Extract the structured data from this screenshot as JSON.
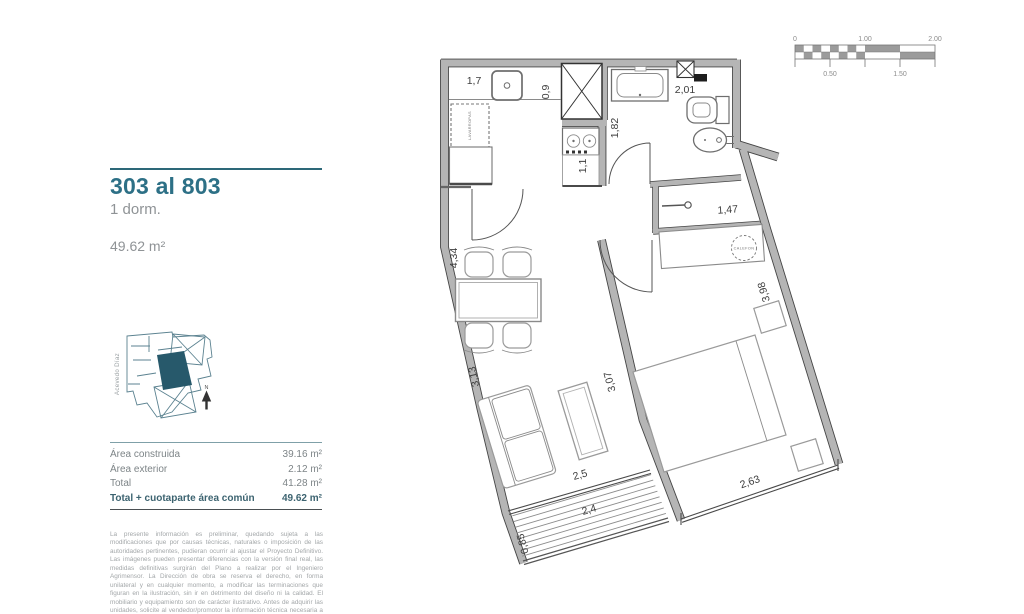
{
  "sidebar": {
    "title": "303 al 803",
    "subtitle": "1 dorm.",
    "area": "49.62 m²",
    "keyplan": {
      "street": "Acevedo Díaz",
      "north": "N"
    },
    "table": {
      "rows": [
        {
          "label": "Área construida",
          "value": "39.16 m²",
          "bold": false
        },
        {
          "label": "Área exterior",
          "value": "2.12 m²",
          "bold": false
        },
        {
          "label": "Total",
          "value": "41.28 m²",
          "bold": false
        },
        {
          "label": "Total + cuotaparte área común",
          "value": "49.62 m²",
          "bold": true
        }
      ]
    },
    "disclaimer": "La presente información es preliminar, quedando sujeta a las modificaciones que por causas técnicas, naturales o imposición de las autoridades pertinentes, pudieran ocurrir al ajustar el Proyecto Definitivo. Las imágenes pueden presentar diferencias con la versión final real, las medidas definitivas surgirán del Plano a realizar por el Ingeniero Agrimensor. La Dirección de obra se reserva el derecho, en forma unilateral y en cualquier momento, a modificar las terminaciones que figuran en la ilustración, sin ir en detrimento del diseño ni la calidad. El mobiliario y equipamiento son de carácter ilustrativo. Antes de adquirir las unidades, solicite al vendedor/promotor la información técnica necesaria a efectos de confirmar los datos obtenidos y poder tomar una decisión informada."
  },
  "scalebar": {
    "top": [
      "0",
      "1.00",
      "2.00"
    ],
    "bottom": [
      "0.50",
      "1.50"
    ]
  },
  "plan": {
    "dims": {
      "d17": "1,7",
      "d09": "0,9",
      "d201": "2,01",
      "d182": "1,82",
      "d11": "1,1",
      "d434": "4,34",
      "d147": "1,47",
      "d398": "3,98",
      "d313": "3,13",
      "d307": "3,07",
      "d25": "2,5",
      "d24": "2,4",
      "d085": "0,85",
      "d263": "2,63"
    },
    "labels": {
      "washer": "LAVARROPAS",
      "heater": "CALEFON"
    }
  },
  "colors": {
    "accent": "#2d7086",
    "wall": "#b5b5b5",
    "wallEdge": "#454545",
    "dim": "#3d3d3d",
    "keyplan": "#5b8290",
    "unit": "#27596b",
    "checker": "#9b9b9b"
  }
}
